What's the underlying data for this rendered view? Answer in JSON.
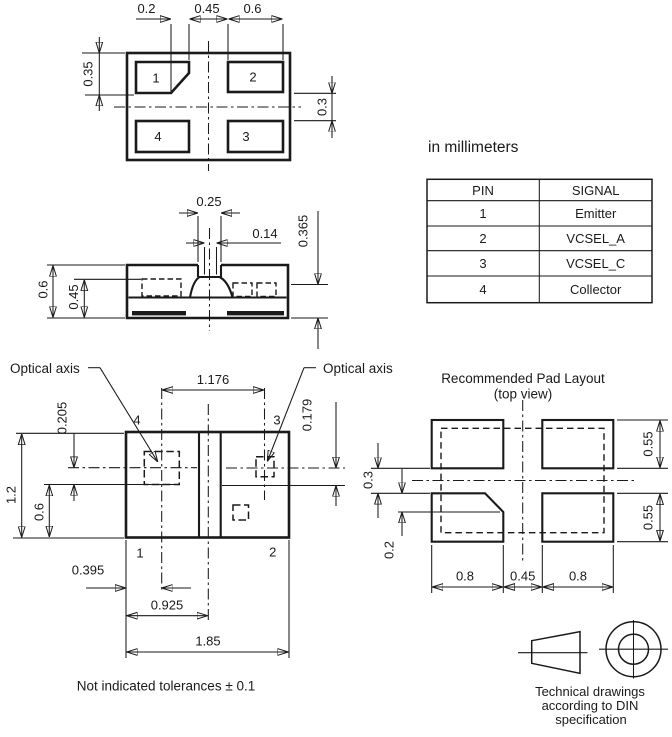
{
  "colors": {
    "line": "#1a1a1a",
    "background": "#ffffff"
  },
  "notes": {
    "units": "in millimeters",
    "tolerance": "Not indicated tolerances ± 0.1"
  },
  "top_view": {
    "pad_labels": {
      "p1": "1",
      "p2": "2",
      "p3": "3",
      "p4": "4"
    },
    "dim_chamfer_x": "0.2",
    "dim_pad_gap_x": "0.45",
    "dim_pad2_width": "0.6",
    "dim_pad1_height": "0.35",
    "dim_pad_gap_y": "0.3"
  },
  "side_view": {
    "dim_lens_recess_width": "0.25",
    "dim_aperture_width": "0.14",
    "dim_emitter_height": "0.365",
    "dim_total_height": "0.6",
    "dim_inner_height": "0.45"
  },
  "pin_table": {
    "header_pin": "PIN",
    "header_signal": "SIGNAL",
    "rows": [
      {
        "pin": "1",
        "signal": "Emitter"
      },
      {
        "pin": "2",
        "signal": "VCSEL_A"
      },
      {
        "pin": "3",
        "signal": "VCSEL_C"
      },
      {
        "pin": "4",
        "signal": "Collector"
      }
    ]
  },
  "bottom_view": {
    "optical_axis_left_label": "Optical axis",
    "optical_axis_right_label": "Optical axis",
    "pad_labels": {
      "p1": "1",
      "p2": "2",
      "p3": "3",
      "p4": "4"
    },
    "dim_axis_spacing": "1.176",
    "dim_axis_to_die_left": "0.205",
    "dim_axis_to_die_right": "0.179",
    "dim_body_height": "1.2",
    "dim_die_to_bottom": "0.6",
    "dim_axis_from_left_edge": "0.395",
    "dim_center_from_left_edge": "0.925",
    "dim_body_width": "1.85"
  },
  "pad_layout": {
    "title": "Recommended Pad Layout",
    "subtitle": "(top view)",
    "dim_row_gap": "0.3",
    "dim_chamfer_depth": "0.2",
    "dim_pad_width_left": "0.8",
    "dim_pad_gap": "0.45",
    "dim_pad_width_right": "0.8",
    "dim_pad_height_top": "0.55",
    "dim_pad_height_bottom": "0.55"
  },
  "din_note": {
    "line1": "Technical drawings",
    "line2": "according to DIN",
    "line3": "specification"
  }
}
